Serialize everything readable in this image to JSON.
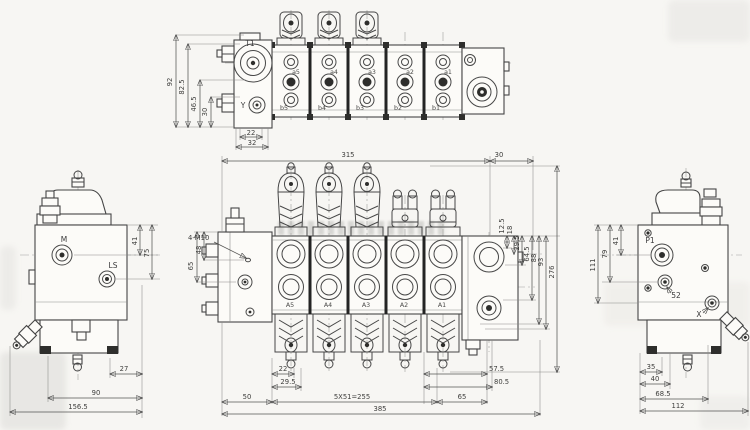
{
  "top_view": {
    "labels": {
      "t1": "T1",
      "y": "Y"
    },
    "a_ports": [
      "a5",
      "a4",
      "a3",
      "a2",
      "a1"
    ],
    "b_ports": [
      "b5",
      "b4",
      "b3",
      "b2",
      "b1"
    ],
    "dims": {
      "d92": "92",
      "d825": "82.5",
      "d465": "46.5",
      "d30": "30",
      "d22": "22",
      "d32": "32"
    }
  },
  "left_view": {
    "labels": {
      "m": "M",
      "ls": "LS"
    },
    "dims": {
      "d41": "41",
      "d75": "75",
      "d27": "27",
      "d90": "90",
      "d1565": "156.5"
    }
  },
  "front_view": {
    "labels": {
      "thread": "4-M10"
    },
    "a_ports": [
      "A5",
      "A4",
      "A3",
      "A2",
      "A1"
    ],
    "dims": {
      "t315": "315",
      "t30": "30",
      "l48": "48",
      "l65": "65",
      "r125": "12.5",
      "r18": "18",
      "r295": "29.5",
      "r645": "64.5",
      "r88": "88",
      "r93": "93",
      "r276": "276",
      "b22": "22",
      "b295": "29.5",
      "b575": "57.5",
      "b805": "80.5",
      "b50": "50",
      "pitch": "5X51=255",
      "b65": "65",
      "b385": "385"
    }
  },
  "right_view": {
    "labels": {
      "p1": "P1",
      "x": "X",
      "d52": "52"
    },
    "dims": {
      "d41": "41",
      "d79": "79",
      "d111": "111",
      "b35": "35",
      "b40": "40",
      "b685": "68.5",
      "b112": "112"
    }
  }
}
